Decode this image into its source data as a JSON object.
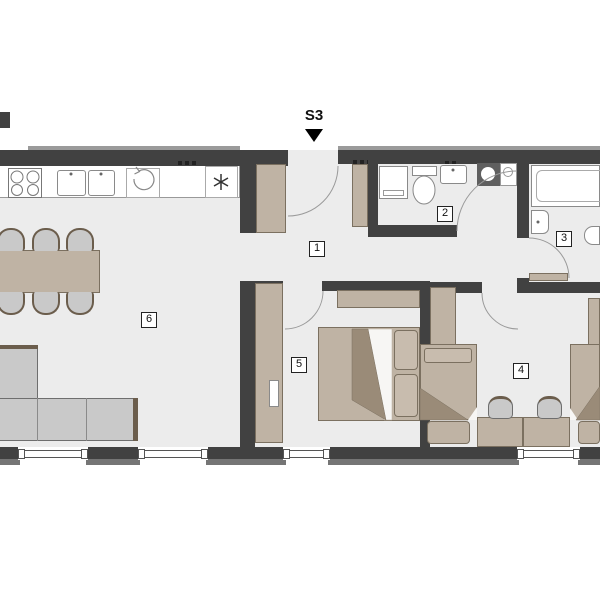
{
  "entrance": {
    "label": "S3"
  },
  "room_labels": {
    "hallway": "1",
    "bathroom_main": "2",
    "bathroom_second": "3",
    "bedroom_right": "4",
    "bedroom_center": "5",
    "living_dining": "6"
  },
  "colors": {
    "wall": "#414141",
    "wall_light": "#9a9a9a",
    "wall_outer": "#757575",
    "floor": "#ececec",
    "wood": "#bfb3a4",
    "wood_dark": "#9a8b78",
    "wood_border": "#7b7060",
    "furniture_gray": "#c9c9c9",
    "furniture_border": "#6e6e6e",
    "cushion": "#6b5d4c",
    "fixture_border": "#8a8a8a",
    "accent_dark": "#5f5f5f",
    "label_border": "#222222"
  }
}
